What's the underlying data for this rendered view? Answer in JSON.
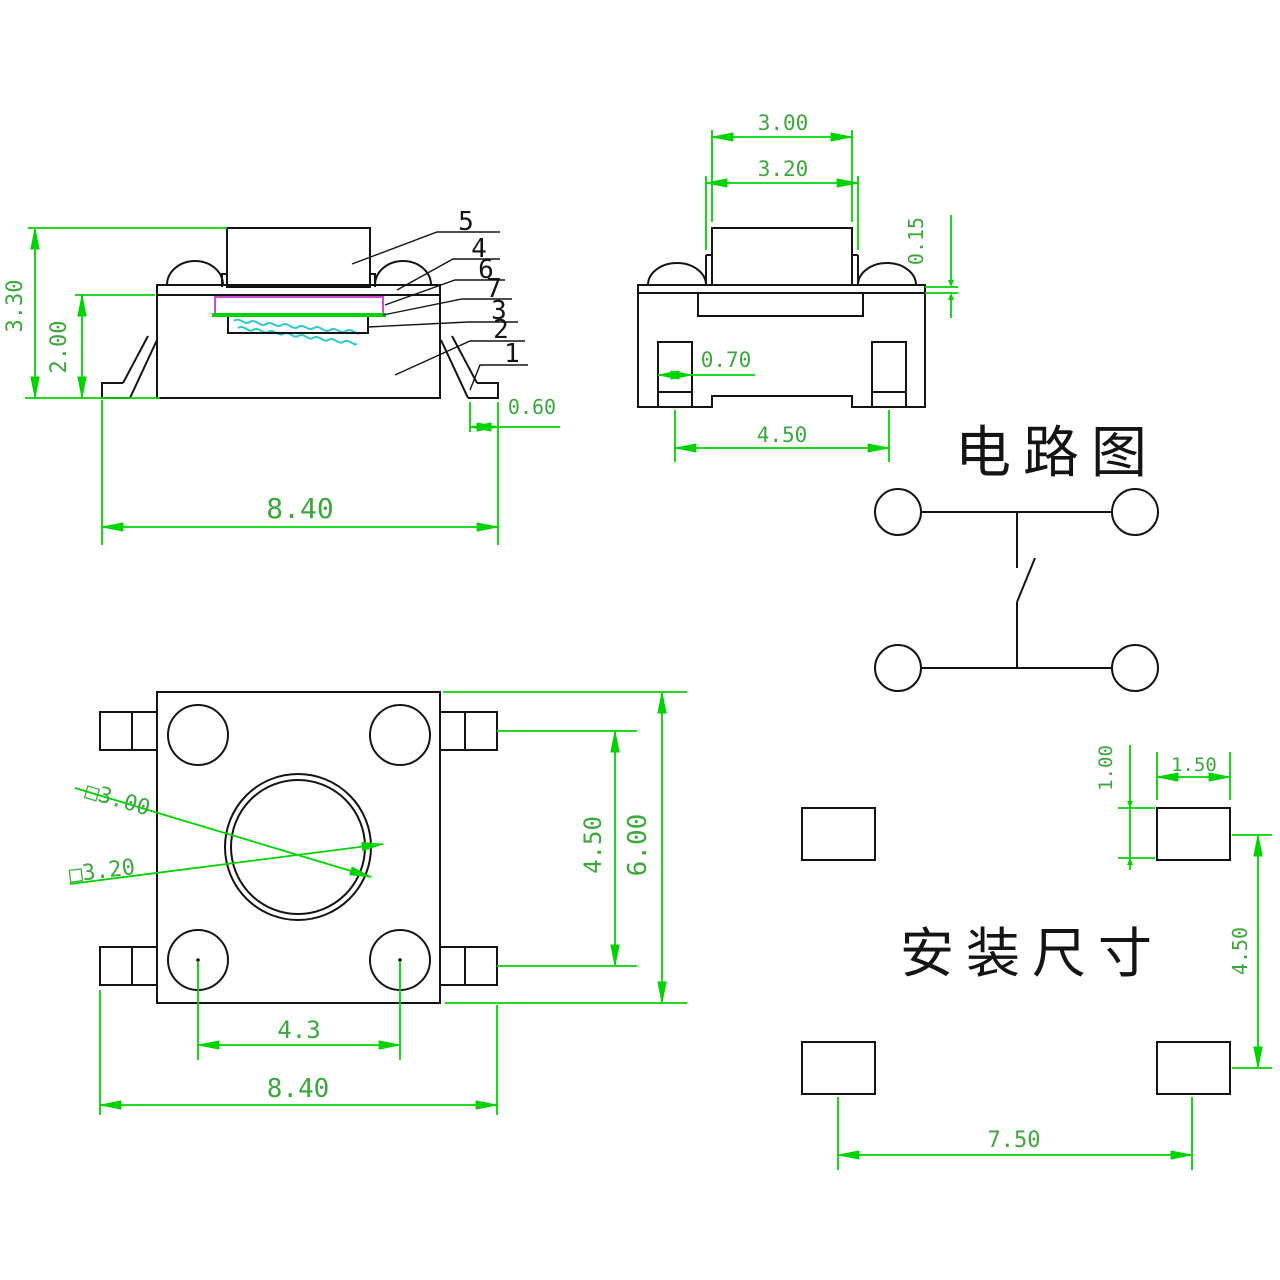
{
  "document": {
    "kind": "tact-switch engineering drawing",
    "views": [
      "side view",
      "front view",
      "circuit diagram",
      "top view",
      "mounting layout"
    ]
  },
  "colors": {
    "background": "#ffffff",
    "geometry_line": "#141414",
    "dimension_line": "#00d400",
    "dimension_text": "#3aa83a",
    "membrane_magenta": "#d944d9",
    "contact_cyan": "#2fc9c9"
  },
  "side_view": {
    "dim_total_height": "3.30",
    "dim_body_height": "2.00",
    "dim_lead_foot": "0.60",
    "dim_total_width": "8.40",
    "part_labels": [
      "5",
      "4",
      "6",
      "7",
      "3",
      "2",
      "1"
    ]
  },
  "front_view": {
    "dim_stem_top_width": "3.00",
    "dim_stem_base_width": "3.20",
    "dim_plate_thickness": "0.15",
    "dim_terminal_width": "0.70",
    "dim_terminal_pitch": "4.50"
  },
  "circuit_diagram": {
    "title": "电路图"
  },
  "top_view": {
    "dim_stem_square_top": "□3.00",
    "dim_stem_square_base": "□3.20",
    "dim_tab_pitch": "4.50",
    "dim_body_width": "6.00",
    "dim_dome_pitch": "4.3",
    "dim_total_width": "8.40"
  },
  "mounting_layout": {
    "title": "安装尺寸",
    "dim_pad_height": "1.00",
    "dim_pad_width": "1.50",
    "dim_pad_pitch_vertical": "4.50",
    "dim_pad_pitch_horizontal": "7.50"
  }
}
